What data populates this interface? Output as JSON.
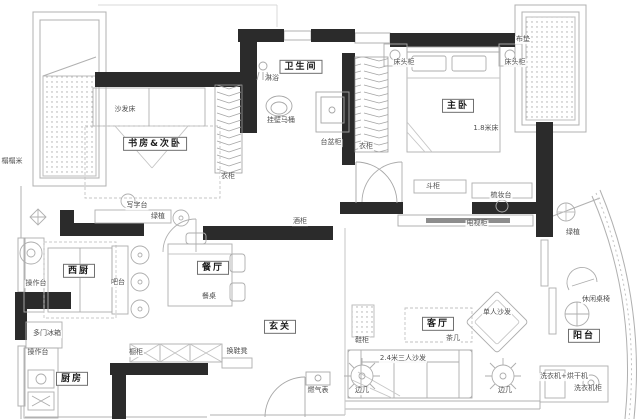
{
  "meta": {
    "drawing_type": "apartment floor plan",
    "background_color": "#ffffff",
    "wall_color": "#2b2b2b",
    "line_color": "#b0b0b0",
    "text_color": "#4f4f4f"
  },
  "rooms": [
    {
      "id": "bathroom",
      "label": "卫生间"
    },
    {
      "id": "study-second-bedroom",
      "label": "书房&次卧"
    },
    {
      "id": "master-bedroom",
      "label": "主卧"
    },
    {
      "id": "west-kitchen",
      "label": "西厨"
    },
    {
      "id": "dining-room",
      "label": "餐厅"
    },
    {
      "id": "entry",
      "label": "玄关"
    },
    {
      "id": "living-room",
      "label": "客厅"
    },
    {
      "id": "balcony",
      "label": "阳台"
    },
    {
      "id": "kitchen",
      "label": "厨房"
    }
  ],
  "furniture_labels": [
    {
      "id": "sofa-bed",
      "label": "沙发床"
    },
    {
      "id": "writing-desk",
      "label": "写字台"
    },
    {
      "id": "plant-study",
      "label": "绿植"
    },
    {
      "id": "wardrobe-study",
      "label": "衣柜"
    },
    {
      "id": "wardrobe-hall",
      "label": "衣柜"
    },
    {
      "id": "shower",
      "label": "淋浴"
    },
    {
      "id": "wall-hung-toilet",
      "label": "挂壁马桶"
    },
    {
      "id": "basin-cabinet",
      "label": "台盆柜"
    },
    {
      "id": "bay-cushion",
      "label": "布垫"
    },
    {
      "id": "nightstand-left",
      "label": "床头柜"
    },
    {
      "id": "nightstand-right",
      "label": "床头柜"
    },
    {
      "id": "bed-size",
      "label": "1.8米床"
    },
    {
      "id": "chest-of-drawers",
      "label": "斗柜"
    },
    {
      "id": "dressing-table",
      "label": "梳妆台"
    },
    {
      "id": "tv-cabinet",
      "label": "电视柜"
    },
    {
      "id": "sideboard",
      "label": "酒柜"
    },
    {
      "id": "counter-west-kitchen",
      "label": "操作台"
    },
    {
      "id": "bar-counter",
      "label": "吧台"
    },
    {
      "id": "fridge",
      "label": "多门冰箱"
    },
    {
      "id": "counter-kitchen",
      "label": "操作台"
    },
    {
      "id": "cupboard",
      "label": "橱柜"
    },
    {
      "id": "shoe-bench",
      "label": "换鞋凳"
    },
    {
      "id": "dining-table",
      "label": "餐桌"
    },
    {
      "id": "gas-meter",
      "label": "燃气表"
    },
    {
      "id": "tea-table",
      "label": "茶几"
    },
    {
      "id": "single-sofa",
      "label": "单人沙发"
    },
    {
      "id": "three-seat-sofa",
      "label": "2.4米三人沙发"
    },
    {
      "id": "side-table-left",
      "label": "边几"
    },
    {
      "id": "side-table-right",
      "label": "边几"
    },
    {
      "id": "shoe-cabinet",
      "label": "鞋柜"
    },
    {
      "id": "plant-balcony",
      "label": "绿植"
    },
    {
      "id": "leisure-table-chairs",
      "label": "休闲桌椅"
    },
    {
      "id": "washer-dryer",
      "label": "洗衣机+烘干机"
    },
    {
      "id": "washer-cabinet",
      "label": "洗衣机柜"
    },
    {
      "id": "tatami",
      "label": "榻榻米"
    }
  ]
}
